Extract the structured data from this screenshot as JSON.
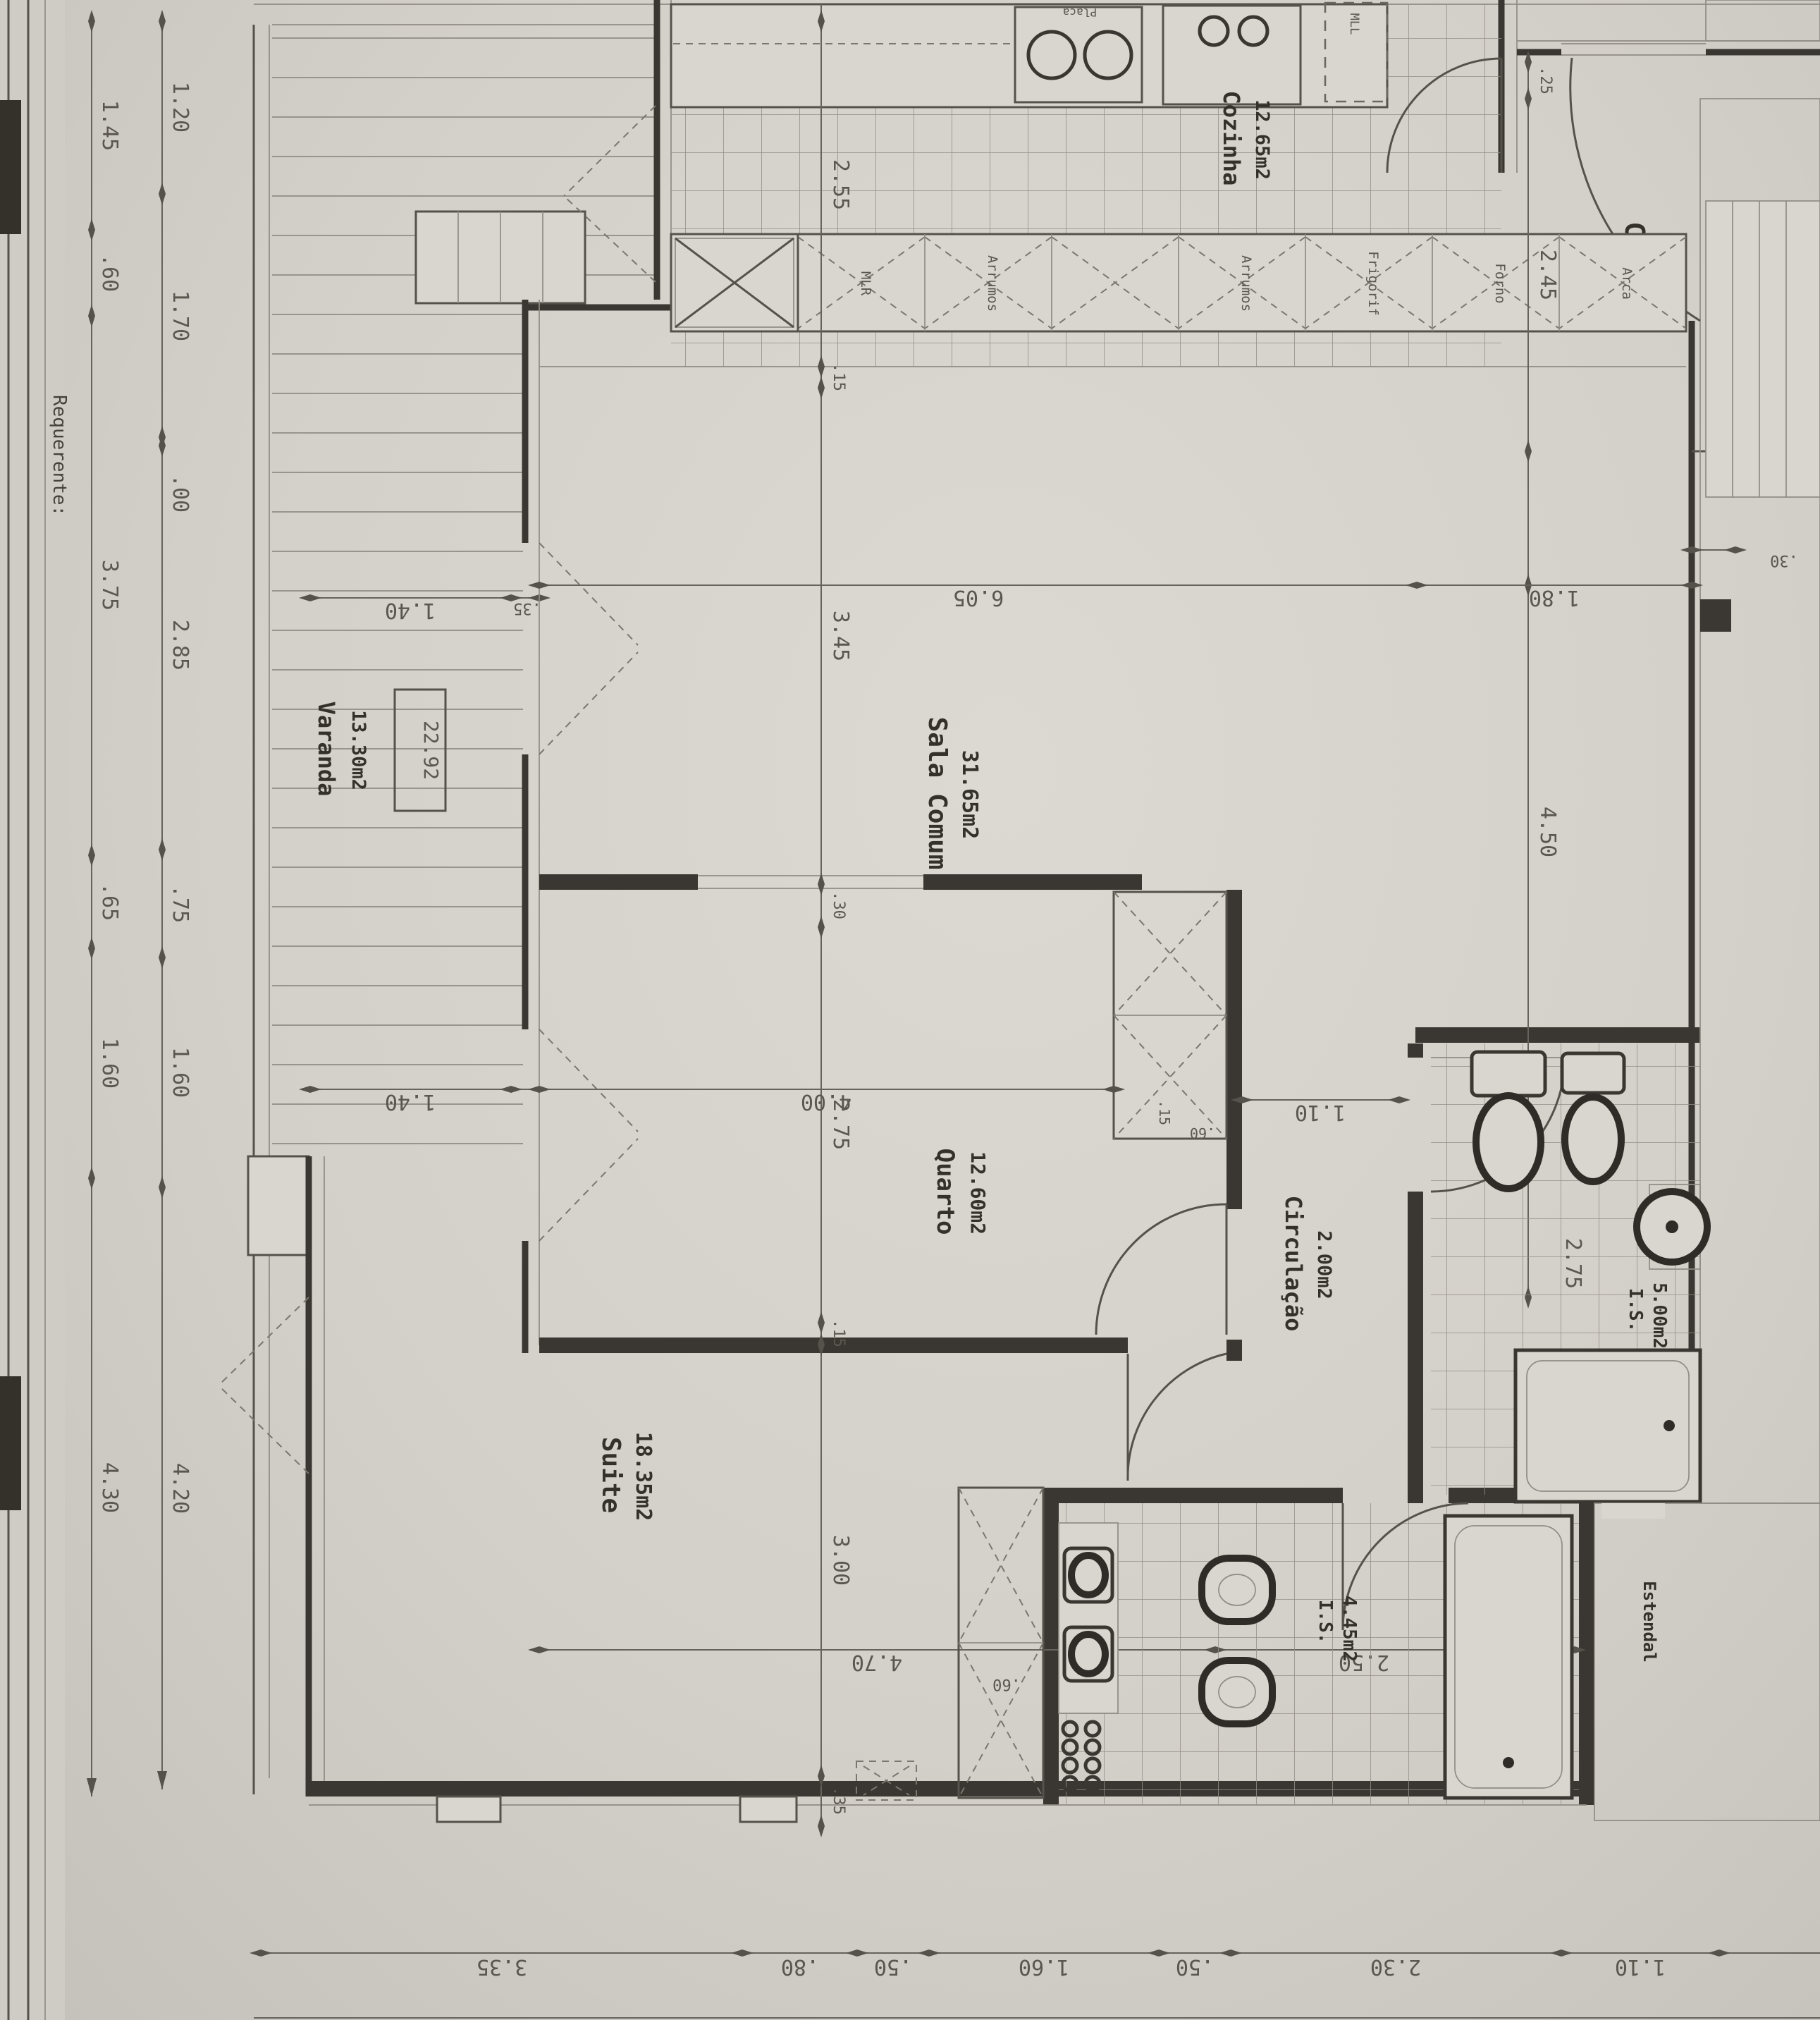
{
  "labels": {
    "code": "C-T2",
    "requerente": "Requerente:",
    "level": "22.92",
    "mll": "MLL",
    "placa": "Placa"
  },
  "rooms": {
    "cozinha": {
      "name": "Cozinha",
      "area": "12.65m2"
    },
    "sala": {
      "name": "Sala Comum",
      "area": "31.65m2"
    },
    "varanda": {
      "name": "Varanda",
      "area": "13.30m2"
    },
    "quarto": {
      "name": "Quarto",
      "area": "12.60m2"
    },
    "circulacao": {
      "name": "Circulação",
      "area": "2.00m2"
    },
    "is1": {
      "name": "I.S.",
      "area": "5.00m2"
    },
    "suite": {
      "name": "Suite",
      "area": "18.35m2"
    },
    "is2": {
      "name": "I.S.",
      "area": "4.45m2"
    },
    "estendal": {
      "name": "Estendal"
    }
  },
  "counter": [
    "",
    "MLR",
    "Arrumos",
    "",
    "Arrumos",
    "Frigorif",
    "Forno",
    "Arca"
  ],
  "dims": {
    "left_outer": [
      "1.45",
      ".60",
      "3.75",
      ".65",
      "1.60",
      "4.30"
    ],
    "left_inner": [
      "1.20",
      "1.70",
      ".00",
      "2.85",
      ".75",
      "1.60",
      "4.20"
    ],
    "bottom": [
      "3.35",
      ".80",
      ".50",
      "1.60",
      ".50",
      "2.30",
      "1.10"
    ],
    "col_a": [
      "2.55",
      ".15",
      "3.45",
      ".30",
      "2.75",
      ".15",
      "3.00",
      ".35"
    ],
    "col_b": [
      ".25",
      "2.45",
      "4.50"
    ],
    "sala": [
      "6.05",
      "1.80"
    ],
    "mid": [
      "1.40",
      "4.00",
      "1.10"
    ],
    "varanda": [
      "1.40",
      ".35"
    ],
    "suite_line": [
      "4.70",
      "2.50",
      ".40"
    ],
    "closet_q": [
      ".15",
      ".60"
    ],
    "closet_s": ".60",
    "bath1": "2.75",
    "wall": ".30"
  }
}
